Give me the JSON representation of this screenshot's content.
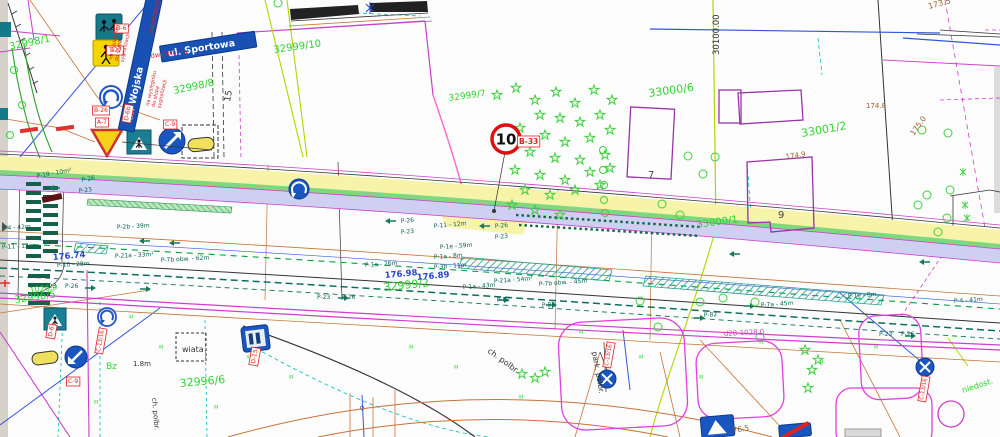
{
  "drawing": {
    "street_sign_wojska": "ul. Wojska",
    "street_sign_sportowa": "ul. Sportowa",
    "speed_limit": {
      "value": "10"
    },
    "colors": {
      "parcel_green": "#2ed32e",
      "marking_teal": "#0d6257",
      "elevation_blue": "#2747cc",
      "elevation_brown": "#a05a2a",
      "sign_red": "#de2121",
      "magenta": "#cc3fcc",
      "sign_blue": "#1a56c0",
      "yellow_band": "#f7f3a8",
      "lavender_band": "#cfcff2"
    },
    "labels": [
      {
        "t": "32998/1",
        "x": 10,
        "y": 50,
        "s": 10,
        "c": "#2ed32e",
        "r": -12,
        "n": "parcel-label"
      },
      {
        "t": "32998/8",
        "x": 174,
        "y": 94,
        "s": 10,
        "c": "#2ed32e",
        "r": -12,
        "n": "parcel-label"
      },
      {
        "t": "32999/10",
        "x": 274,
        "y": 53,
        "s": 10,
        "c": "#2ed32e",
        "r": -8,
        "n": "parcel-label"
      },
      {
        "t": "32999/7",
        "x": 449,
        "y": 101,
        "s": 9,
        "c": "#2ed32e",
        "r": -8,
        "n": "parcel-label"
      },
      {
        "t": "33000/6",
        "x": 649,
        "y": 97,
        "s": 11,
        "c": "#2ed32e",
        "r": -8,
        "n": "parcel-label"
      },
      {
        "t": "33001/2",
        "x": 802,
        "y": 137,
        "s": 11,
        "c": "#2ed32e",
        "r": -10,
        "n": "parcel-label"
      },
      {
        "t": "33000/1",
        "x": 697,
        "y": 228,
        "s": 10,
        "c": "#2ed32e",
        "r": -8,
        "n": "parcel-label"
      },
      {
        "t": "32999/2",
        "x": 384,
        "y": 291,
        "s": 11,
        "c": "#2ed32e",
        "r": -6,
        "n": "parcel-label"
      },
      {
        "t": "32996/5",
        "x": 15,
        "y": 303,
        "s": 10,
        "c": "#2ed32e",
        "r": -8,
        "n": "parcel-label"
      },
      {
        "t": "1026.0",
        "x": 30,
        "y": 293,
        "s": 8,
        "c": "#2ed32e",
        "r": -8,
        "n": "parcel-label"
      },
      {
        "t": "32996/6",
        "x": 180,
        "y": 387,
        "s": 11,
        "c": "#2ed32e",
        "r": -5,
        "n": "parcel-label"
      },
      {
        "t": "Bz",
        "x": 106,
        "y": 369,
        "s": 9,
        "c": "#2ed32e",
        "n": "zone-label"
      },
      {
        "t": "niedost.",
        "x": 963,
        "y": 393,
        "s": 8,
        "c": "#2ed32e",
        "r": -18,
        "n": "zone-label"
      },
      {
        "t": "7",
        "x": 648,
        "y": 178,
        "s": 10,
        "c": "#444",
        "n": "building-number"
      },
      {
        "t": "9",
        "x": 778,
        "y": 218,
        "s": 10,
        "c": "#444",
        "n": "building-number"
      },
      {
        "t": "15",
        "x": 230,
        "y": 102,
        "s": 9,
        "c": "#333",
        "r": -80,
        "n": "dimension-label"
      },
      {
        "t": "30100.00",
        "x": 719,
        "y": 55,
        "s": 8.5,
        "c": "#333",
        "r": -90,
        "n": "coordinate-label"
      },
      {
        "t": "wiata",
        "x": 182,
        "y": 352,
        "s": 8,
        "c": "#333",
        "n": "shelter-label"
      },
      {
        "t": "ch. polbr.",
        "x": 487,
        "y": 352,
        "s": 8,
        "c": "#333",
        "r": 36,
        "n": "surface-label"
      },
      {
        "t": "park. polbr.",
        "x": 592,
        "y": 352,
        "s": 7.5,
        "c": "#333",
        "r": 80,
        "n": "surface-label"
      },
      {
        "t": "ch. polbr.",
        "x": 152,
        "y": 398,
        "s": 7,
        "c": "#333",
        "r": 85,
        "n": "surface-label"
      },
      {
        "t": "1.8m",
        "x": 133,
        "y": 366,
        "s": 7,
        "c": "#333",
        "n": "dimension-label"
      },
      {
        "t": "173.5",
        "x": 929,
        "y": 9,
        "s": 8,
        "c": "#a05a2a",
        "r": -15,
        "n": "elevation-label"
      },
      {
        "t": "174.8",
        "x": 866,
        "y": 108,
        "s": 7,
        "c": "#a05a2a",
        "n": "elevation-label"
      },
      {
        "t": "175.0",
        "x": 914,
        "y": 136,
        "s": 7.5,
        "c": "#a05a2a",
        "r": -55,
        "n": "elevation-label"
      },
      {
        "t": "174.9",
        "x": 786,
        "y": 159,
        "s": 7,
        "c": "#a05a2a",
        "r": -8,
        "n": "elevation-label"
      },
      {
        "t": "76.5",
        "x": 733,
        "y": 433,
        "s": 7.5,
        "c": "#a05a2a",
        "r": -10,
        "n": "elevation-label"
      },
      {
        "t": "176.98",
        "x": 385,
        "y": 278,
        "s": 8.5,
        "c": "#2747cc",
        "bold": 1,
        "r": -5,
        "n": "spot-elevation"
      },
      {
        "t": "176.89",
        "x": 417,
        "y": 280,
        "s": 8.5,
        "c": "#2747cc",
        "bold": 1,
        "r": -5,
        "n": "spot-elevation"
      },
      {
        "t": "176.74",
        "x": 53,
        "y": 260,
        "s": 8.5,
        "c": "#2747cc",
        "bold": 1,
        "r": -5,
        "n": "spot-elevation"
      },
      {
        "t": "P-19 - 10m²",
        "x": 37,
        "y": 178,
        "s": 6,
        "c": "#0d6257",
        "r": -10,
        "n": "marking-label"
      },
      {
        "t": "P-26",
        "x": 82,
        "y": 182,
        "s": 6,
        "c": "#0d6257",
        "r": -10,
        "n": "marking-label"
      },
      {
        "t": "P-23",
        "x": 79,
        "y": 193,
        "s": 6,
        "c": "#0d6257",
        "r": -8,
        "n": "marking-label"
      },
      {
        "t": "P-2b - 39m",
        "x": 117,
        "y": 229,
        "s": 6,
        "c": "#0d6257",
        "r": -3,
        "n": "marking-label"
      },
      {
        "t": "P-4 - 42m",
        "x": 2,
        "y": 230,
        "s": 6,
        "c": "#0d6257",
        "r": -3,
        "n": "marking-label"
      },
      {
        "t": "P-11 - 12m",
        "x": 2,
        "y": 249,
        "s": 6,
        "c": "#0d6257",
        "r": -3,
        "n": "marking-label"
      },
      {
        "t": "P-21a - 33m²",
        "x": 115,
        "y": 258,
        "s": 6,
        "c": "#0d6257",
        "r": -3,
        "n": "marking-label"
      },
      {
        "t": "P-7b obw. - 62m",
        "x": 161,
        "y": 262,
        "s": 6,
        "c": "#0d6257",
        "r": -3,
        "n": "marking-label"
      },
      {
        "t": "P-10 - 28m",
        "x": 57,
        "y": 267,
        "s": 6,
        "c": "#0d6257",
        "r": -3,
        "n": "marking-label"
      },
      {
        "t": "P-23",
        "x": 43,
        "y": 288,
        "s": 6,
        "c": "#0d6257",
        "n": "marking-label"
      },
      {
        "t": "P-26",
        "x": 65,
        "y": 288,
        "s": 6,
        "c": "#0d6257",
        "n": "marking-label"
      },
      {
        "t": "P-26",
        "x": 401,
        "y": 223,
        "s": 6,
        "c": "#0d6257",
        "r": -5,
        "n": "marking-label"
      },
      {
        "t": "P-23",
        "x": 401,
        "y": 234,
        "s": 6,
        "c": "#0d6257",
        "r": -5,
        "n": "marking-label"
      },
      {
        "t": "P-11 - 12m",
        "x": 434,
        "y": 228,
        "s": 6,
        "c": "#0d6257",
        "r": -5,
        "n": "marking-label"
      },
      {
        "t": "P-26",
        "x": 495,
        "y": 228,
        "s": 6,
        "c": "#0d6257",
        "r": -5,
        "n": "marking-label"
      },
      {
        "t": "P-23",
        "x": 495,
        "y": 239,
        "s": 6,
        "c": "#0d6257",
        "r": -5,
        "n": "marking-label"
      },
      {
        "t": "P-1e - 59m",
        "x": 440,
        "y": 249,
        "s": 6,
        "c": "#0d6257",
        "r": -4,
        "n": "marking-label"
      },
      {
        "t": "P-1a - 8m",
        "x": 434,
        "y": 259,
        "s": 6,
        "c": "#0d6257",
        "r": -4,
        "n": "marking-label"
      },
      {
        "t": "P-1a - 26m",
        "x": 365,
        "y": 267,
        "s": 6,
        "c": "#0d6257",
        "r": -4,
        "n": "marking-label"
      },
      {
        "t": "P-3b - 11m",
        "x": 434,
        "y": 269,
        "s": 6,
        "c": "#0d6257",
        "r": -4,
        "n": "marking-label"
      },
      {
        "t": "P-23",
        "x": 317,
        "y": 299,
        "s": 6,
        "c": "#0d6257",
        "n": "marking-label"
      },
      {
        "t": "P-26",
        "x": 342,
        "y": 299,
        "s": 6,
        "c": "#0d6257",
        "n": "marking-label"
      },
      {
        "t": "P-21a - 54m²",
        "x": 494,
        "y": 283,
        "s": 6,
        "c": "#0d6257",
        "r": -4,
        "n": "marking-label"
      },
      {
        "t": "P-7b obw. - 45m",
        "x": 539,
        "y": 286,
        "s": 6,
        "c": "#0d6257",
        "r": -4,
        "n": "marking-label"
      },
      {
        "t": "P-1a - 43m",
        "x": 463,
        "y": 289,
        "s": 6,
        "c": "#0d6257",
        "r": -4,
        "n": "marking-label"
      },
      {
        "t": "P-82",
        "x": 497,
        "y": 302,
        "s": 6,
        "c": "#0d6257",
        "r": -4,
        "n": "marking-label"
      },
      {
        "t": "P-82",
        "x": 542,
        "y": 307,
        "s": 6,
        "c": "#0d6257",
        "r": -4,
        "n": "marking-label"
      },
      {
        "t": "P-7a - 45m",
        "x": 761,
        "y": 307,
        "s": 6,
        "c": "#0d6257",
        "r": -4,
        "n": "marking-label"
      },
      {
        "t": "P-1e - 8m",
        "x": 848,
        "y": 298,
        "s": 6,
        "c": "#0d6257",
        "r": -4,
        "n": "marking-label"
      },
      {
        "t": "P-4 - 41m",
        "x": 954,
        "y": 303,
        "s": 6,
        "c": "#0d6257",
        "r": -4,
        "n": "marking-label"
      },
      {
        "t": "P-23",
        "x": 879,
        "y": 336,
        "s": 6,
        "c": "#0d6257",
        "n": "marking-label"
      },
      {
        "t": "P-26",
        "x": 901,
        "y": 336,
        "s": 6,
        "c": "#0d6257",
        "n": "marking-label"
      },
      {
        "t": "P-82",
        "x": 704,
        "y": 317,
        "s": 6,
        "c": "#0d6257",
        "r": -4,
        "n": "marking-label"
      },
      {
        "t": "d28-1028.0",
        "x": 724,
        "y": 336,
        "s": 7,
        "c": "#cc3fcc",
        "r": -3,
        "n": "pipe-label"
      },
      {
        "t": "B-33",
        "x": 519,
        "y": 144,
        "s": 7.5,
        "c": "#de2121",
        "b": 1,
        "bold": 1,
        "n": "sign-code"
      },
      {
        "t": "D-6",
        "x": 116,
        "y": 30,
        "s": 6,
        "c": "#de2121",
        "b": 1,
        "n": "sign-code"
      },
      {
        "t": "T-27",
        "x": 109,
        "y": 52,
        "s": 6,
        "c": "#de2121",
        "b": 1,
        "n": "sign-code"
      },
      {
        "t": "B-26",
        "x": 94,
        "y": 112,
        "s": 6,
        "c": "#de2121",
        "b": 1,
        "n": "sign-code"
      },
      {
        "t": "A-7",
        "x": 97,
        "y": 124,
        "s": 6,
        "c": "#de2121",
        "b": 1,
        "n": "sign-code"
      },
      {
        "t": "D-6b",
        "x": 128,
        "y": 121,
        "s": 6,
        "c": "#de2121",
        "b": 1,
        "r": -80,
        "n": "sign-code"
      },
      {
        "t": "C-9",
        "x": 165,
        "y": 126,
        "s": 6,
        "c": "#de2121",
        "b": 1,
        "n": "sign-code"
      },
      {
        "t": "D-6",
        "x": 52,
        "y": 337,
        "s": 6,
        "c": "#de2121",
        "b": 1,
        "r": -80,
        "n": "sign-code"
      },
      {
        "t": "C-13/16",
        "x": 100,
        "y": 352,
        "s": 5.5,
        "c": "#de2121",
        "b": 1,
        "r": -80,
        "n": "sign-code"
      },
      {
        "t": "C-9",
        "x": 68,
        "y": 383,
        "s": 6,
        "c": "#de2121",
        "b": 1,
        "n": "sign-code"
      },
      {
        "t": "D-15",
        "x": 255,
        "y": 364,
        "s": 6,
        "c": "#de2121",
        "b": 1,
        "r": -80,
        "n": "sign-code"
      },
      {
        "t": "C-13/16",
        "x": 608,
        "y": 366,
        "s": 5.5,
        "c": "#de2121",
        "b": 1,
        "r": -80,
        "n": "sign-code"
      },
      {
        "t": "C-13/16",
        "x": 923,
        "y": 400,
        "s": 5.5,
        "c": "#de2121",
        "b": 1,
        "r": -80,
        "n": "sign-code"
      },
      {
        "t": "na wysięgniku do słupa sygnalizacji",
        "lines": [
          "na wysięgniku",
          "do słupa",
          "sygnalizacji"
        ],
        "x": 112,
        "y": 60,
        "s": 5,
        "c": "#de2121",
        "r": -78,
        "n": "mounting-note"
      },
      {
        "t": "na wysięgniku do słupa sygnalizacji",
        "lines": [
          "na wysięgniku",
          "do słupa",
          "sygnalizacji"
        ],
        "x": 149,
        "y": 106,
        "s": 5,
        "c": "#de2121",
        "r": -78,
        "n": "mounting-note"
      },
      {
        "t": "dwustronny",
        "x": 152,
        "y": 35,
        "s": 6,
        "c": "#de2121",
        "r": -77,
        "n": "mounting-note"
      },
      {
        "t": "dwustronny",
        "x": 151,
        "y": 58,
        "s": 6.5,
        "c": "#de2121",
        "r": -8,
        "n": "mounting-note"
      }
    ]
  }
}
